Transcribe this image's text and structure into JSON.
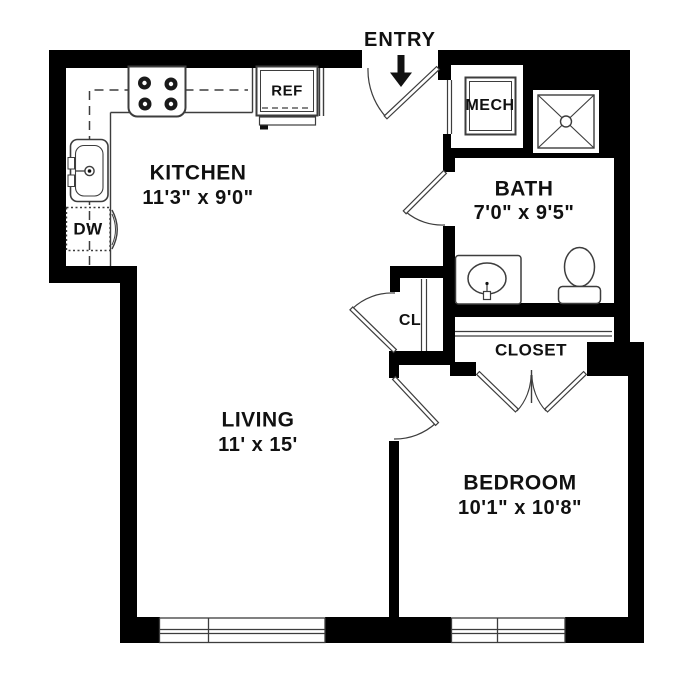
{
  "plan": {
    "entry": {
      "label": "ENTRY"
    },
    "rooms": {
      "kitchen": {
        "name": "KITCHEN",
        "dimensions": "11'3\" x 9'0\""
      },
      "bath": {
        "name": "BATH",
        "dimensions": "7'0\" x 9'5\""
      },
      "living": {
        "name": "LIVING",
        "dimensions": "11' x 15'"
      },
      "bedroom": {
        "name": "BEDROOM",
        "dimensions": "10'1\" x 10'8\""
      },
      "mech": {
        "name": "MECH"
      },
      "cl": {
        "name": "CL"
      },
      "closet": {
        "name": "CLOSET"
      }
    },
    "appliances": {
      "refrigerator": "REF",
      "dishwasher": "DW"
    },
    "colors": {
      "wall": "#000000",
      "line": "#3d3d3d",
      "text": "#111111",
      "background": "#ffffff"
    }
  }
}
